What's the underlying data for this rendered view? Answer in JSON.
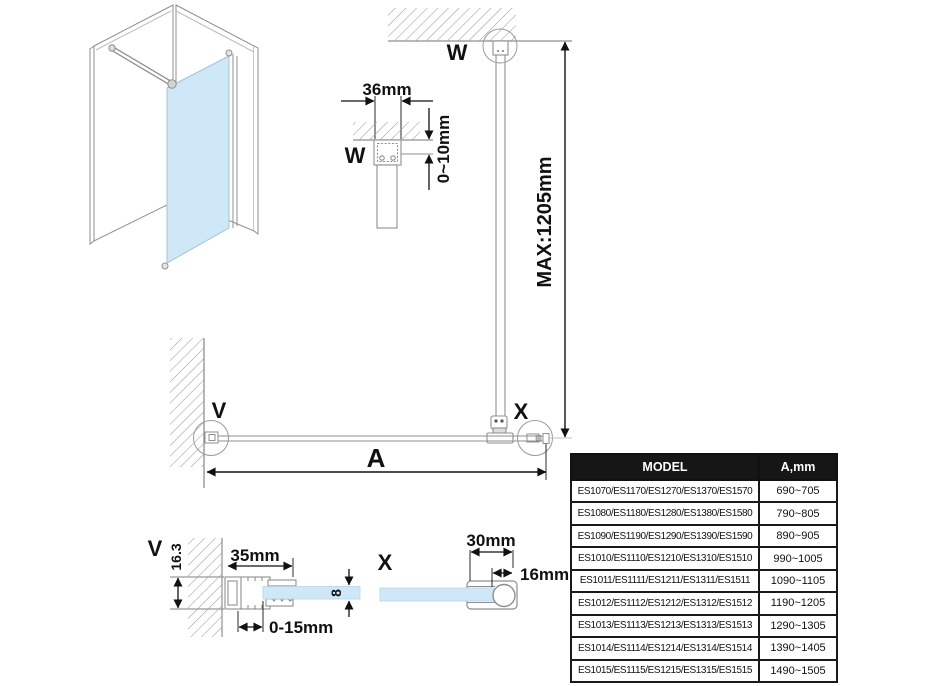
{
  "labels": {
    "detail_v": "V",
    "detail_w": "W",
    "detail_x": "X"
  },
  "dimensions": {
    "ceiling_bracket_width": "36mm",
    "ceiling_gap": "0~10mm",
    "support_bar_max": "MAX:1205mm",
    "panel_width": "A",
    "wall_profile_width": "35mm",
    "wall_profile_depth": "16.3",
    "wall_adjustment_range": "0-15mm",
    "glass_thickness": "8",
    "clamp_width": "30mm",
    "bar_diameter": "16mm"
  },
  "colors": {
    "glass_blue": "#cfe8f8",
    "line_gray": "#8f8f8f",
    "dimension_black": "#111111"
  },
  "table": {
    "headers": {
      "model": "MODEL",
      "a_mm": "A,mm"
    },
    "rows": [
      {
        "model": "ES1070/ES1170/ES1270/ES1370/ES1570",
        "a": "690~705"
      },
      {
        "model": "ES1080/ES1180/ES1280/ES1380/ES1580",
        "a": "790~805"
      },
      {
        "model": "ES1090/ES1190/ES1290/ES1390/ES1590",
        "a": "890~905"
      },
      {
        "model": "ES1010/ES1110/ES1210/ES1310/ES1510",
        "a": "990~1005"
      },
      {
        "model": "ES1011/ES1111/ES1211/ES1311/ES1511",
        "a": "1090~1105"
      },
      {
        "model": "ES1012/ES1112/ES1212/ES1312/ES1512",
        "a": "1190~1205"
      },
      {
        "model": "ES1013/ES1113/ES1213/ES1313/ES1513",
        "a": "1290~1305"
      },
      {
        "model": "ES1014/ES1114/ES1214/ES1314/ES1514",
        "a": "1390~1405"
      },
      {
        "model": "ES1015/ES1115/ES1215/ES1315/ES1515",
        "a": "1490~1505"
      }
    ]
  }
}
